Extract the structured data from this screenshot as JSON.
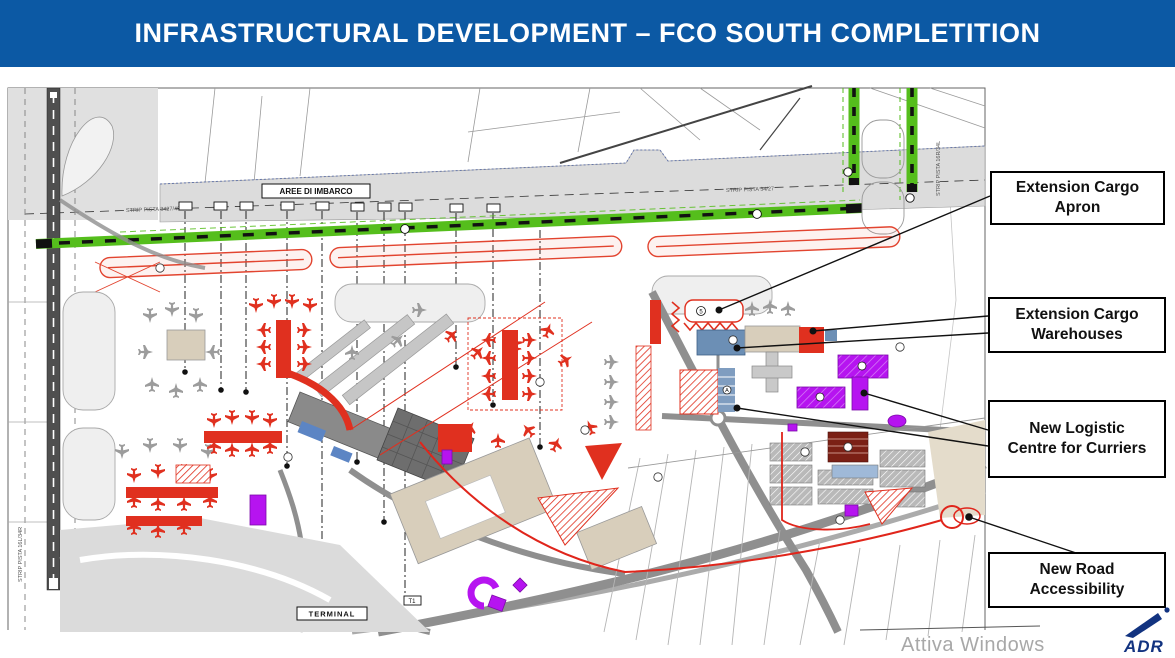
{
  "title": {
    "text": "INFRASTRUCTURAL DEVELOPMENT – FCO SOUTH COMPLETITION"
  },
  "callouts": [
    {
      "id": "extension-cargo-apron",
      "label": "Extension Cargo Apron"
    },
    {
      "id": "extension-cargo-warehouses",
      "label": "Extension Cargo Warehouses"
    },
    {
      "id": "new-logistic-centre",
      "label": "New Logistic Centre for Curriers"
    },
    {
      "id": "new-road-accessibility",
      "label": "New Road Accessibility"
    }
  ],
  "map_labels": {
    "boarding_area": "AREE DI IMBARCO",
    "terminal": "TERMINAL",
    "t4": "T4",
    "t3": "T3",
    "t1": "T1",
    "strip_left": "STRIP PISTA 16L/34R",
    "strip_top": "STRIP PISTA 3427/4000M",
    "strip_top_right": "STRIP PISTA 34/27",
    "strip_right": "STRIP PISTA 16R/34L"
  },
  "map_markers": {
    "cargo_apron_number": "5",
    "logistic_block_letter": "A"
  },
  "watermark": {
    "text": "Attiva Windows"
  },
  "logo": {
    "text": "ADR"
  },
  "colors": {
    "banner_blue": "#0c59a4",
    "runway_green": "#55be1c",
    "new_work_red": "#e0301f",
    "logistic_purple": "#b614f0",
    "warehouse_blue": "#6c8fb5",
    "road_gray": "#8f8f8f",
    "adr_navy": "#123380"
  }
}
